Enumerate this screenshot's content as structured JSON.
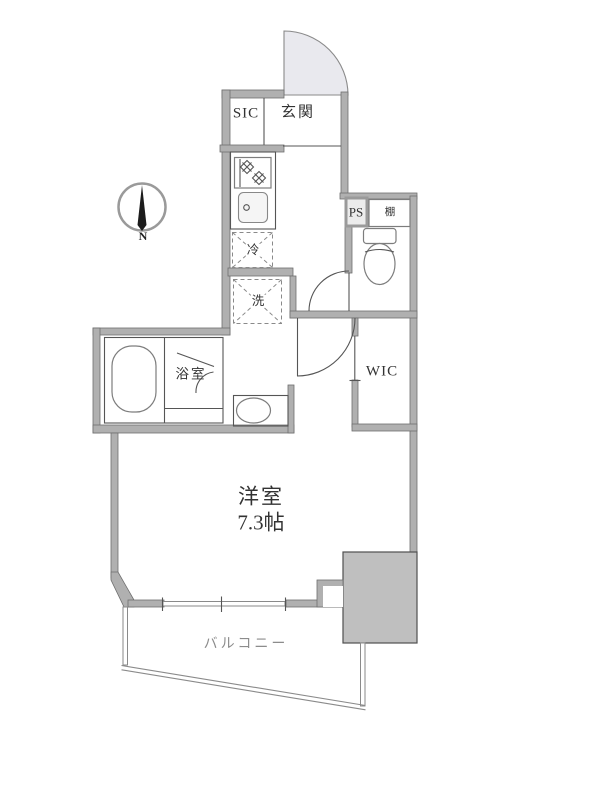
{
  "compass": {
    "north_label": "N"
  },
  "rooms": {
    "shoe_closet": "SIC",
    "entrance": "玄関",
    "pipe_space": "PS",
    "shelf": "棚",
    "refrigerator": "冷",
    "washer": "洗",
    "bathroom": "浴室",
    "walk_in_closet": "WIC",
    "main_room_name": "洋室",
    "main_room_size": "7.3帖",
    "balcony": "バルコニー"
  },
  "colors": {
    "wall": "#b0b0b0",
    "wall_edge": "#6e6e6e",
    "line": "#555555",
    "door_swing_fill": "#e9e9ee",
    "structure_block": "#bfbfbf",
    "text": "#333333",
    "balcony_text": "#8c8c8c"
  }
}
